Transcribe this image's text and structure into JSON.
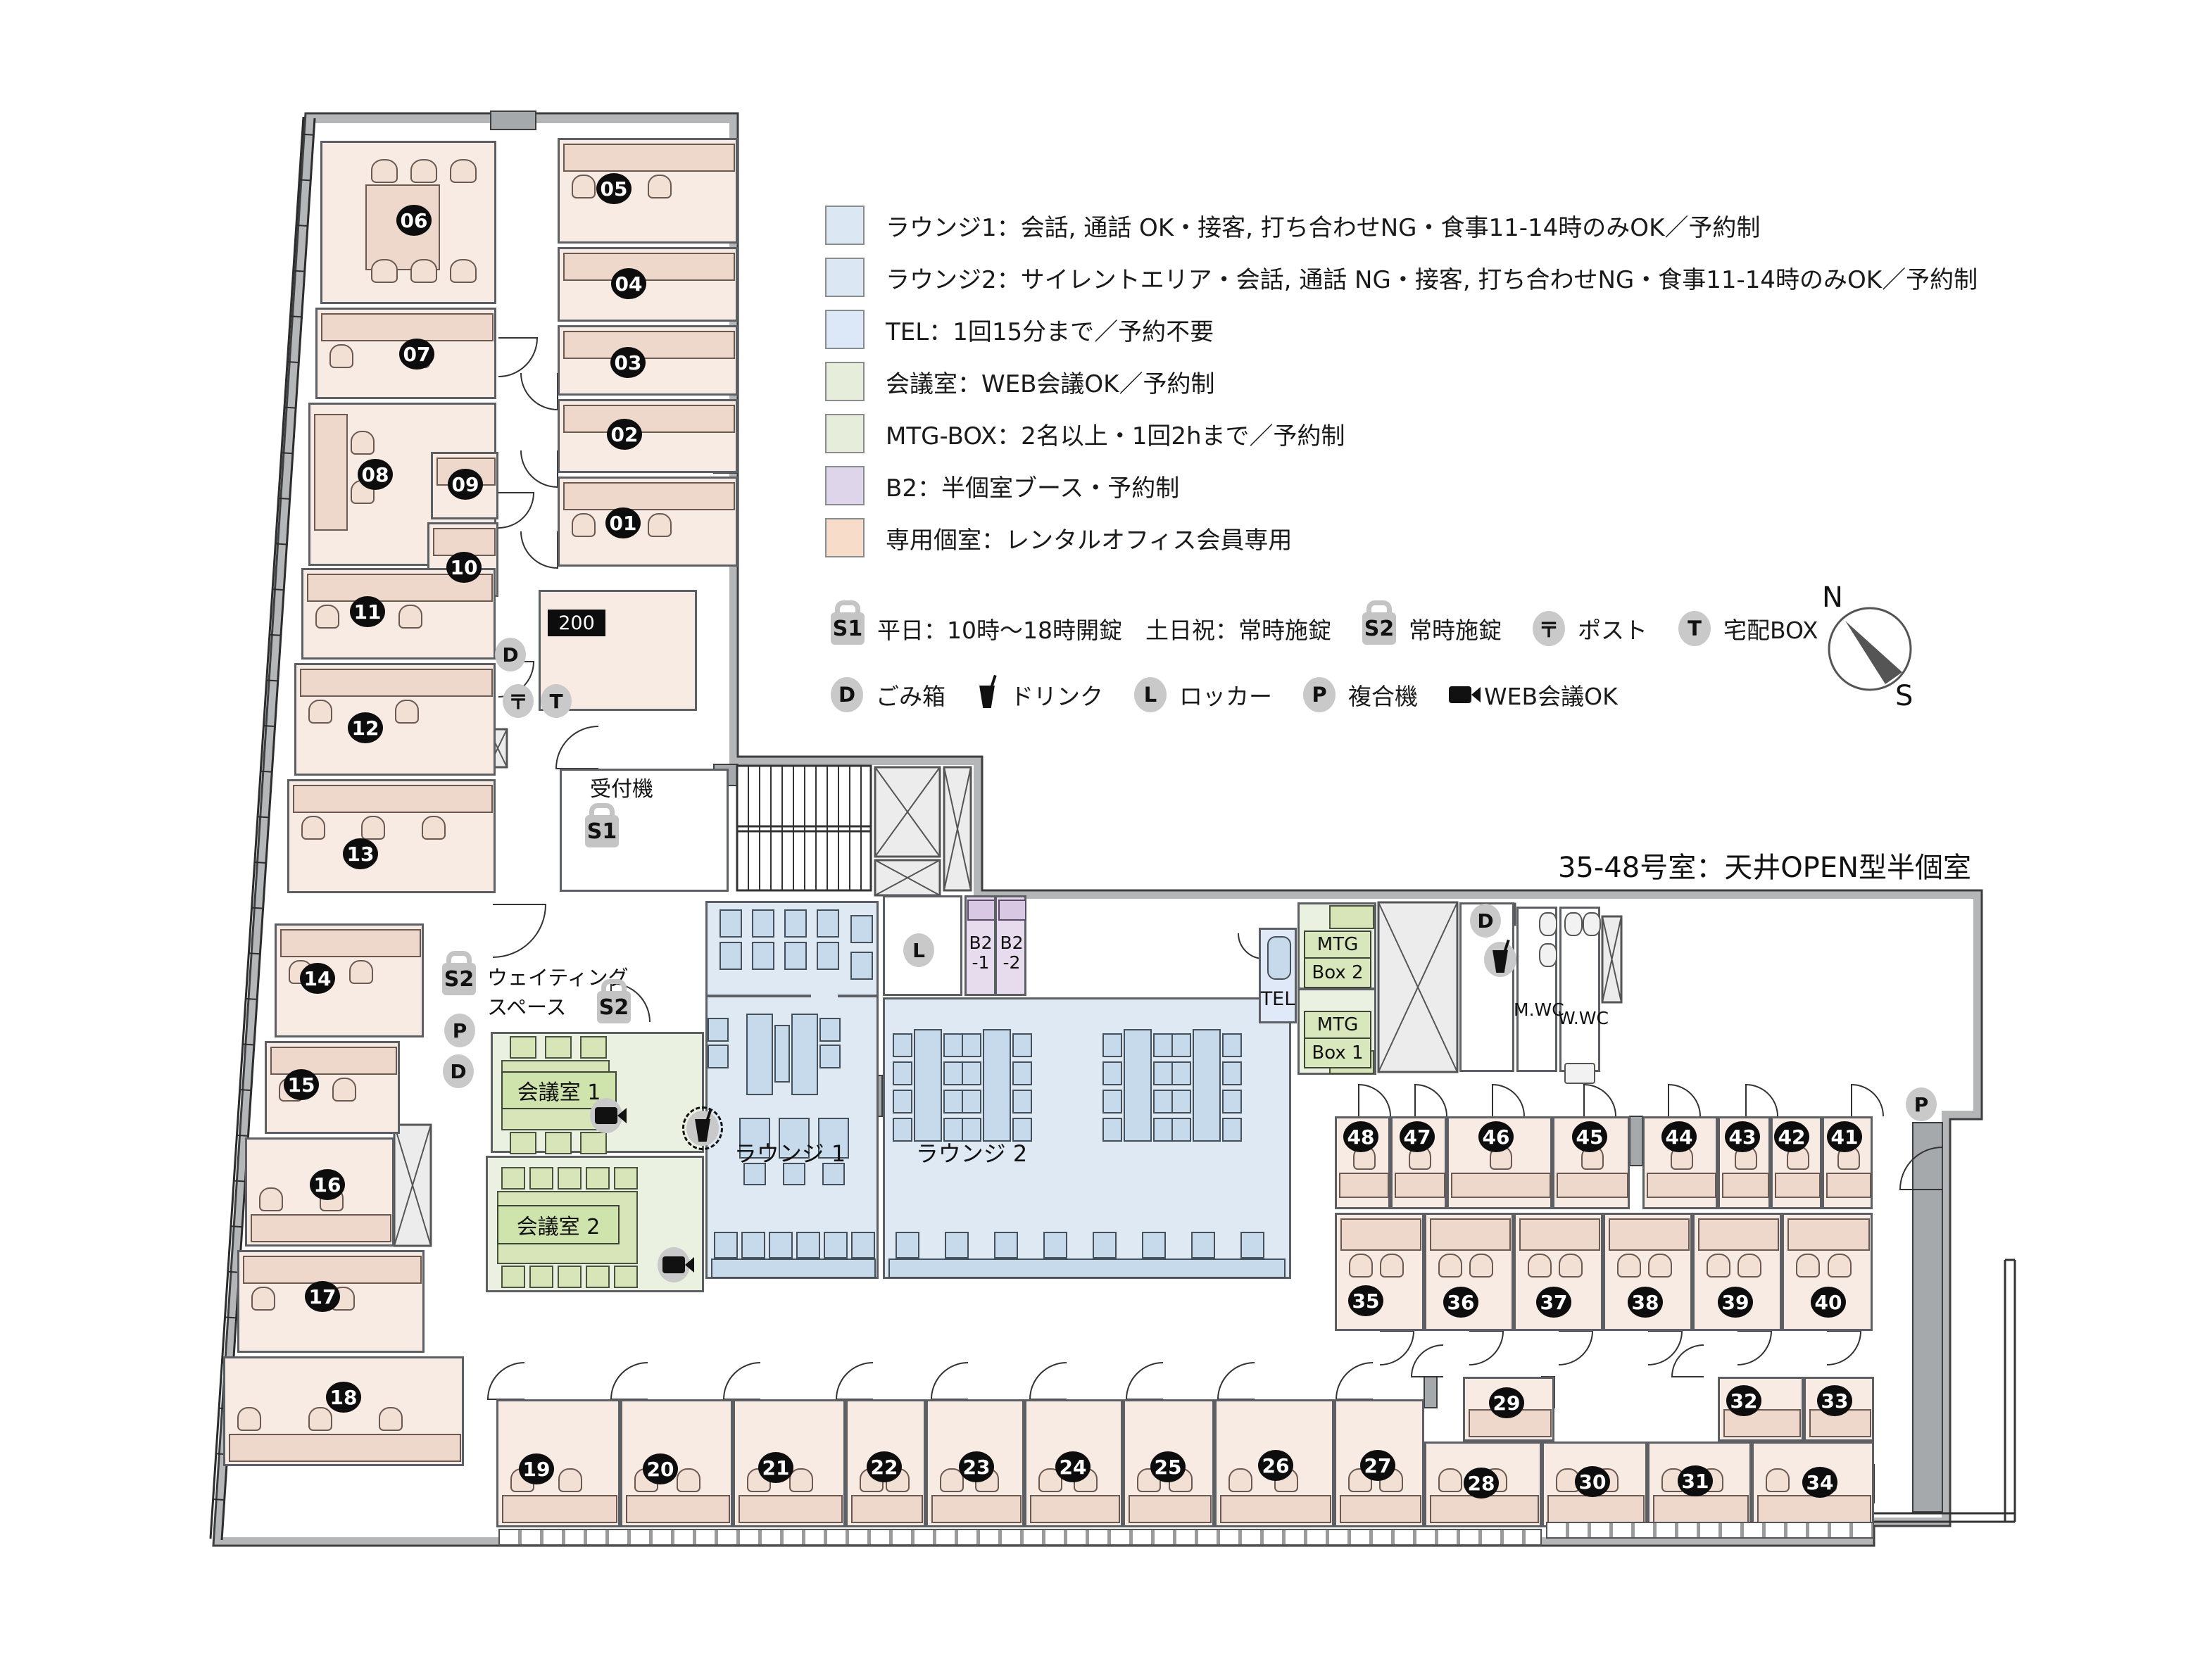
{
  "legend": [
    {
      "color": "#dbe7f3",
      "text": "ラウンジ1：会話, 通話 OK・接客, 打ち合わせNG・食事11-14時のみOK／予約制"
    },
    {
      "color": "#dbe7f3",
      "text": "ラウンジ2：サイレントエリア・会話, 通話 NG・接客, 打ち合わせNG・食事11-14時のみOK／予約制"
    },
    {
      "color": "#dce8f7",
      "text": "TEL：1回15分まで／予約不要"
    },
    {
      "color": "#e6eedb",
      "text": "会議室：WEB会議OK／予約制"
    },
    {
      "color": "#e6eedb",
      "text": "MTG-BOX：2名以上・1回2hまで／予約制"
    },
    {
      "color": "#ded5eb",
      "text": "B2：半個室ブース・予約制"
    },
    {
      "color": "#f7ddc9",
      "text": "専用個室：レンタルオフィス会員専用"
    }
  ],
  "icon_legend_row1": [
    {
      "type": "lock",
      "label": "S1",
      "text": "平日：10時〜18時開錠　土日祝：常時施錠"
    },
    {
      "type": "lock",
      "label": "S2",
      "text": "常時施錠"
    },
    {
      "type": "circle",
      "label": "〒",
      "text": "ポスト"
    },
    {
      "type": "circle",
      "label": "T",
      "text": "宅配BOX"
    }
  ],
  "icon_legend_row2": [
    {
      "type": "circle",
      "label": "D",
      "text": "ごみ箱"
    },
    {
      "type": "cup",
      "label": "",
      "text": "ドリンク"
    },
    {
      "type": "circle",
      "label": "L",
      "text": "ロッカー"
    },
    {
      "type": "circle",
      "label": "P",
      "text": "複合機"
    },
    {
      "type": "cam",
      "label": "",
      "text": "WEB会議OK"
    }
  ],
  "compass": {
    "n": "N",
    "s": "S"
  },
  "area_note": "35-48号室：天井OPEN型半個室",
  "rooms": [
    "01",
    "02",
    "03",
    "04",
    "05",
    "06",
    "07",
    "08",
    "09",
    "10",
    "11",
    "12",
    "13",
    "14",
    "15",
    "16",
    "17",
    "18",
    "19",
    "20",
    "21",
    "22",
    "23",
    "24",
    "25",
    "26",
    "27",
    "28",
    "29",
    "30",
    "31",
    "32",
    "33",
    "34",
    "35",
    "36",
    "37",
    "38",
    "39",
    "40",
    "41",
    "42",
    "43",
    "44",
    "45",
    "46",
    "47",
    "48"
  ],
  "labels": {
    "reception": "受付機",
    "room200": "200",
    "waiting1": "ウェイティング",
    "waiting2": "スペース",
    "lounge1": "ラウンジ 1",
    "lounge2": "ラウンジ 2",
    "meeting1": "会議室 1",
    "meeting2": "会議室 2",
    "mtg_a": "MTG",
    "mtg_box2": "Box 2",
    "mtg_box1": "Box 1",
    "b2a": "B2",
    "b2a2": "-1",
    "b2b": "B2",
    "b2b2": "-2",
    "tel": "TEL",
    "mwc": "M.WC",
    "wwc": "W.WC"
  },
  "glyphs": {
    "s1": "S1",
    "s2": "S2",
    "d": "D",
    "p": "P",
    "l": "L",
    "t": "T",
    "post": "〒"
  }
}
